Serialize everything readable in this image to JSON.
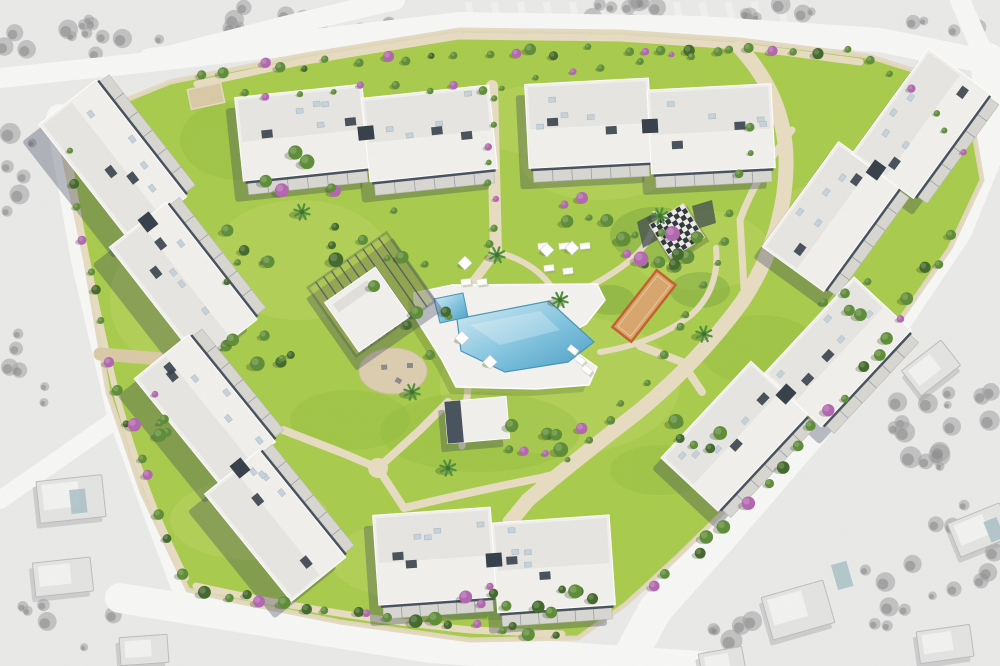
{
  "scene": {
    "description": "aerial masterplan rendering of a residential apartment development with central pool garden, surrounded by desaturated grayscale aerial context",
    "building_count": 7
  },
  "canvas": {
    "w": 1000,
    "h": 666
  },
  "palette": {
    "lawn": "#a9cc4b",
    "lawnLight": "#c2db69",
    "lawnDark": "#8db73a",
    "treeG": "#5d8c36",
    "treeD": "#42682a",
    "treeP": "#b266ae",
    "treeL": "#86b34a",
    "treeShadow": "rgba(30,45,20,0.25)",
    "path": "#e7dcc1",
    "pathDark": "#d9c9a6",
    "wall": "#e4d9c0",
    "roofWhite": "#f1f0ec",
    "roofLight": "#e0dfdb",
    "facadeDark": "#47515c",
    "facadeDeep": "#353f49",
    "terrace": "#d8d6d1",
    "acUnit": "#c6d2da",
    "shadow": "rgba(50,60,80,0.32)",
    "deck": "#f3f2ef",
    "poolEdge": "#4795b8",
    "sand": "#d8a56d",
    "sandBorder": "#c2602c",
    "dirt": "#dccdb0",
    "bgGray": "#e9e9e8",
    "road": "#f7f7f6",
    "grayTree": "#a0a0a0",
    "grayTreeDark": "#818181",
    "houseGray": "#e3e3e2",
    "houseRoof": "#f2f2f1",
    "houseStroke": "#bcbcbc",
    "housePool": "#a9c0c6"
  },
  "context": {
    "roads": [
      {
        "d": "M150,60 L460,24 L700,28 L880,40 L988,62",
        "w": 24
      },
      {
        "d": "M395,0 L285,26 L160,58",
        "w": 20
      },
      {
        "d": "M0,78 L150,62",
        "w": 20
      },
      {
        "d": "M60,118 L85,260 L120,410 L160,520 L188,594",
        "w": 28
      },
      {
        "d": "M115,420 L0,500",
        "w": 18
      },
      {
        "d": "M120,598 L430,648 L700,666",
        "w": 30
      },
      {
        "d": "M988,60 L992,140 L955,230 L888,330 L812,430 L728,528 L655,610 L625,666",
        "w": 34
      },
      {
        "d": "M960,0 L985,58",
        "w": 20
      }
    ],
    "orchard_rows": {
      "x0": 468,
      "x1": 790,
      "step": 26,
      "y0": 2,
      "y1": 30,
      "w": 7
    },
    "gray_tree_clusters": [
      {
        "x": 60,
        "y": 30,
        "rx": 70,
        "ry": 28,
        "n": 12
      },
      {
        "x": 230,
        "y": 28,
        "rx": 90,
        "ry": 26,
        "n": 14
      },
      {
        "x": 390,
        "y": 42,
        "rx": 60,
        "ry": 22,
        "n": 8
      },
      {
        "x": 620,
        "y": 12,
        "rx": 80,
        "ry": 14,
        "n": 8
      },
      {
        "x": 790,
        "y": 14,
        "rx": 60,
        "ry": 12,
        "n": 6
      },
      {
        "x": 950,
        "y": 25,
        "rx": 40,
        "ry": 18,
        "n": 5
      },
      {
        "x": 935,
        "y": 400,
        "rx": 60,
        "ry": 70,
        "n": 16
      },
      {
        "x": 960,
        "y": 560,
        "rx": 50,
        "ry": 60,
        "n": 10
      },
      {
        "x": 860,
        "y": 600,
        "rx": 60,
        "ry": 40,
        "n": 8
      },
      {
        "x": 60,
        "y": 620,
        "rx": 60,
        "ry": 30,
        "n": 6
      },
      {
        "x": 40,
        "y": 360,
        "rx": 40,
        "ry": 45,
        "n": 6
      },
      {
        "x": 20,
        "y": 180,
        "rx": 30,
        "ry": 50,
        "n": 6
      },
      {
        "x": 760,
        "y": 632,
        "rx": 50,
        "ry": 20,
        "n": 5
      },
      {
        "x": 900,
        "y": 250,
        "rx": 30,
        "ry": 30,
        "n": 6
      }
    ],
    "houses": [
      {
        "x": 38,
        "y": 478,
        "w": 66,
        "h": 42,
        "rot": -6,
        "pool": [
          70,
          490,
          16,
          24
        ]
      },
      {
        "x": 34,
        "y": 560,
        "w": 58,
        "h": 34,
        "rot": -6
      },
      {
        "x": 120,
        "y": 636,
        "w": 48,
        "h": 28,
        "rot": -4
      },
      {
        "x": 766,
        "y": 588,
        "w": 64,
        "h": 44,
        "rot": -16,
        "pool": [
          842,
          576,
          16,
          26
        ]
      },
      {
        "x": 906,
        "y": 352,
        "w": 50,
        "h": 32,
        "rot": -38
      },
      {
        "x": 952,
        "y": 512,
        "w": 56,
        "h": 36,
        "rot": -22,
        "pool": [
          986,
          524,
          14,
          22
        ]
      },
      {
        "x": 918,
        "y": 628,
        "w": 54,
        "h": 32,
        "rot": -8
      },
      {
        "x": 700,
        "y": 650,
        "w": 44,
        "h": 24,
        "rot": -10
      }
    ]
  },
  "site": {
    "boundary": [
      [
        170,
        82
      ],
      [
        300,
        56
      ],
      [
        460,
        30
      ],
      [
        620,
        32
      ],
      [
        740,
        40
      ],
      [
        868,
        56
      ],
      [
        938,
        78
      ],
      [
        972,
        122
      ],
      [
        982,
        180
      ],
      [
        950,
        248
      ],
      [
        893,
        330
      ],
      [
        822,
        408
      ],
      [
        748,
        488
      ],
      [
        676,
        558
      ],
      [
        626,
        604
      ],
      [
        578,
        638
      ],
      [
        470,
        640
      ],
      [
        340,
        622
      ],
      [
        240,
        602
      ],
      [
        188,
        590
      ],
      [
        142,
        492
      ],
      [
        108,
        392
      ],
      [
        86,
        262
      ],
      [
        58,
        128
      ]
    ],
    "lawn_light_patches": [
      [
        300,
        260,
        90,
        60
      ],
      [
        560,
        385,
        120,
        70
      ],
      [
        250,
        520,
        80,
        40
      ],
      [
        700,
        250,
        70,
        40
      ],
      [
        820,
        220,
        50,
        35
      ],
      [
        420,
        560,
        90,
        40
      ],
      [
        600,
        160,
        80,
        40
      ],
      [
        160,
        300,
        50,
        60
      ],
      [
        540,
        120,
        70,
        35
      ]
    ],
    "lawn_dark_patches": [
      [
        480,
        432,
        100,
        40
      ],
      [
        350,
        420,
        60,
        30
      ],
      [
        760,
        350,
        60,
        35
      ],
      [
        240,
        140,
        60,
        40
      ],
      [
        660,
        470,
        50,
        25
      ]
    ],
    "groundcover": [
      [
        655,
        235,
        45,
        28
      ],
      [
        610,
        300,
        25,
        15
      ],
      [
        700,
        290,
        30,
        18
      ],
      [
        500,
        606,
        100,
        14
      ]
    ],
    "paths": [
      {
        "d": "M197,84 L300,62 L458,36 L620,38 L738,46 L860,62",
        "w": 7,
        "c": "path"
      },
      {
        "d": "M492,86 L496,252",
        "w": 12,
        "c": "path"
      },
      {
        "d": "M496,252 L470,286",
        "w": 9,
        "c": "path"
      },
      {
        "d": "M740,48 Q788,100 786,168 Q784,238 742,302 Q698,362 638,412 Q578,458 528,500 L510,522",
        "w": 15,
        "c": "path"
      },
      {
        "d": "M283,430 L340,452 L378,468 L420,430 L448,402",
        "w": 8,
        "c": "path"
      },
      {
        "d": "M378,468 L404,508",
        "w": 8,
        "c": "path"
      },
      {
        "d": "M404,508 Q470,492 540,478 L566,472",
        "w": 8,
        "c": "path"
      },
      {
        "d": "M66,140 Q84,260 118,400 Q146,500 186,578",
        "w": 6,
        "c": "path"
      },
      {
        "d": "M100,354 L198,362",
        "w": 13,
        "c": "pathDark"
      },
      {
        "d": "M196,586 Q330,616 470,630 L562,634",
        "w": 7,
        "c": "path"
      },
      {
        "d": "M560,300 Q600,284 628,262 Q656,240 654,214",
        "w": 6,
        "c": "path"
      },
      {
        "d": "M600,352 Q652,344 690,316 Q720,290 716,248",
        "w": 6,
        "c": "path"
      },
      {
        "d": "M496,252 Q540,262 560,300",
        "w": 6,
        "c": "path"
      },
      {
        "d": "M792,130 Q756,176 740,220 L744,288",
        "w": 7,
        "c": "path"
      },
      {
        "d": "M640,346 L682,362 L702,392",
        "w": 8,
        "c": "path"
      },
      {
        "d": "M468,388 L462,446",
        "w": 7,
        "c": "path"
      }
    ],
    "tree_belts": [
      {
        "p1": [
          205,
          72
        ],
        "c": [
          530,
          44
        ],
        "p2": [
          852,
          50
        ],
        "n": 26,
        "rmin": 3,
        "rmax": 6,
        "mix": "ggpgd"
      },
      {
        "p1": [
          872,
          62
        ],
        "c": [
          930,
          96
        ],
        "p2": [
          962,
          150
        ],
        "n": 6,
        "rmin": 3,
        "rmax": 5,
        "mix": "ggp"
      },
      {
        "p1": [
          948,
          236
        ],
        "c": [
          845,
          428
        ],
        "p2": [
          652,
          588
        ],
        "n": 20,
        "rmin": 3.5,
        "rmax": 7,
        "mix": "ggdgp"
      },
      {
        "p1": [
          204,
          590
        ],
        "c": [
          380,
          622
        ],
        "p2": [
          556,
          632
        ],
        "n": 18,
        "rmin": 3.5,
        "rmax": 7,
        "mix": "dgdpg"
      },
      {
        "p1": [
          72,
          150
        ],
        "c": [
          96,
          360
        ],
        "p2": [
          182,
          572
        ],
        "n": 15,
        "rmin": 3,
        "rmax": 6,
        "mix": "gdgp"
      },
      {
        "p1": [
          752,
          124
        ],
        "c": [
          724,
          330
        ],
        "p2": [
          564,
          462
        ],
        "n": 15,
        "rmin": 2.5,
        "rmax": 4.5,
        "mix": "ggg"
      },
      {
        "p1": [
          490,
          100
        ],
        "c": [
          492,
          170
        ],
        "p2": [
          494,
          244
        ],
        "n": 8,
        "rmin": 2.5,
        "rmax": 4,
        "mix": "ggp"
      },
      {
        "p1": [
          240,
          96
        ],
        "c": [
          360,
          86
        ],
        "p2": [
          484,
          88
        ],
        "n": 9,
        "rmin": 2.5,
        "rmax": 4.5,
        "mix": "gpg"
      },
      {
        "p1": [
          504,
          88
        ],
        "c": [
          620,
          60
        ],
        "p2": [
          730,
          52
        ],
        "n": 8,
        "rmin": 2.5,
        "rmax": 4,
        "mix": "ggp"
      }
    ],
    "tree_clusters": [
      {
        "x": 662,
        "y": 238,
        "rx": 52,
        "ry": 36,
        "n": 13,
        "mix": "gdpg"
      },
      {
        "x": 380,
        "y": 248,
        "rx": 55,
        "ry": 40,
        "n": 9,
        "mix": "gdg"
      },
      {
        "x": 300,
        "y": 180,
        "rx": 40,
        "ry": 30,
        "n": 7,
        "mix": "gpg"
      },
      {
        "x": 540,
        "y": 440,
        "rx": 70,
        "ry": 26,
        "n": 8,
        "mix": "gpg"
      },
      {
        "x": 262,
        "y": 352,
        "rx": 45,
        "ry": 26,
        "n": 7,
        "mix": "gdg"
      },
      {
        "x": 152,
        "y": 428,
        "rx": 34,
        "ry": 36,
        "n": 6,
        "mix": "gpg"
      },
      {
        "x": 704,
        "y": 432,
        "rx": 36,
        "ry": 26,
        "n": 6,
        "mix": "gdg"
      },
      {
        "x": 848,
        "y": 296,
        "rx": 30,
        "ry": 22,
        "n": 5,
        "mix": "gg"
      },
      {
        "x": 536,
        "y": 598,
        "rx": 85,
        "ry": 16,
        "n": 11,
        "mix": "dgpd"
      },
      {
        "x": 430,
        "y": 332,
        "rx": 26,
        "ry": 36,
        "n": 5,
        "mix": "gdg"
      },
      {
        "x": 586,
        "y": 214,
        "rx": 30,
        "ry": 20,
        "n": 5,
        "mix": "gpg"
      },
      {
        "x": 240,
        "y": 250,
        "rx": 30,
        "ry": 40,
        "n": 6,
        "mix": "gdg"
      }
    ],
    "palms": [
      [
        497,
        255
      ],
      [
        302,
        212
      ],
      [
        412,
        392
      ],
      [
        660,
        216
      ],
      [
        704,
        334
      ],
      [
        448,
        468
      ],
      [
        560,
        300
      ]
    ],
    "buildings": [
      {
        "id": "apartment-block-west",
        "cx": 148,
        "cy": 222,
        "rot": 52,
        "flip": true,
        "blocks": [
          [
            -70,
            -10,
            148,
            72
          ],
          [
            70,
            10,
            148,
            72
          ]
        ]
      },
      {
        "id": "apartment-block-northwest",
        "cx": 366,
        "cy": 133,
        "rot": -6,
        "flip": false,
        "blocks": [
          [
            -63,
            -7,
            128,
            84
          ],
          [
            63,
            7,
            128,
            84
          ]
        ]
      },
      {
        "id": "apartment-block-north",
        "cx": 650,
        "cy": 126,
        "rot": -3,
        "flip": false,
        "blocks": [
          [
            -61,
            -6,
            124,
            84
          ],
          [
            61,
            6,
            124,
            84
          ]
        ]
      },
      {
        "id": "apartment-block-east",
        "cx": 876,
        "cy": 170,
        "rot": -54,
        "flip": false,
        "blocks": [
          [
            -64,
            -9,
            130,
            76
          ],
          [
            64,
            9,
            130,
            76
          ]
        ]
      },
      {
        "id": "apartment-block-southeast",
        "cx": 786,
        "cy": 394,
        "rot": -47,
        "flip": false,
        "blocks": [
          [
            -66,
            -9,
            132,
            78
          ],
          [
            66,
            9,
            132,
            78
          ]
        ]
      },
      {
        "id": "apartment-block-south",
        "cx": 494,
        "cy": 560,
        "rot": -4,
        "flip": false,
        "blocks": [
          [
            -59,
            -8,
            118,
            90
          ],
          [
            59,
            8,
            118,
            90
          ]
        ]
      },
      {
        "id": "apartment-block-southwest",
        "cx": 240,
        "cy": 468,
        "rot": 51,
        "flip": true,
        "blocks": [
          [
            -67,
            -9,
            138,
            70
          ],
          [
            67,
            9,
            138,
            70
          ]
        ]
      }
    ],
    "clubhouse": {
      "cx": 378,
      "cy": 297,
      "rot": -35,
      "pergola": [
        -4,
        -6,
        96,
        84
      ],
      "roof": [
        -16,
        4,
        62,
        60
      ]
    },
    "pavilion": {
      "cx": 477,
      "cy": 420,
      "rot": -5,
      "w": 62,
      "h": 42
    },
    "pool": {
      "deck": [
        [
          414,
          293
        ],
        [
          452,
          285
        ],
        [
          597,
          284
        ],
        [
          605,
          300
        ],
        [
          586,
          324
        ],
        [
          559,
          340
        ],
        [
          597,
          367
        ],
        [
          589,
          385
        ],
        [
          536,
          389
        ],
        [
          456,
          387
        ],
        [
          442,
          360
        ],
        [
          415,
          317
        ]
      ],
      "water_main": [
        [
          457,
          319
        ],
        [
          549,
          301
        ],
        [
          594,
          342
        ],
        [
          568,
          362
        ],
        [
          505,
          372
        ],
        [
          461,
          351
        ]
      ],
      "water_small": [
        [
          434,
          299
        ],
        [
          463,
          293
        ],
        [
          468,
          317
        ],
        [
          440,
          323
        ]
      ]
    },
    "amenities": {
      "chessboard": {
        "cx": 677,
        "cy": 231,
        "rot": -32,
        "size": 40
      },
      "petanque_court": {
        "cx": 644,
        "cy": 306,
        "rot": -52,
        "w": 72,
        "h": 24
      },
      "playground": {
        "cx": 393,
        "cy": 371,
        "rx": 34,
        "ry": 23
      },
      "shade_sails": [
        [
          [
            637,
            222
          ],
          [
            656,
            212
          ],
          [
            661,
            238
          ],
          [
            643,
            248
          ]
        ],
        [
          [
            692,
            206
          ],
          [
            712,
            200
          ],
          [
            716,
            223
          ],
          [
            697,
            229
          ]
        ]
      ]
    },
    "furniture": {
      "lounger_rows": [
        {
          "x": 543,
          "y": 246,
          "rot": -7,
          "n": 3,
          "dx": 21,
          "dy": 0
        },
        {
          "x": 549,
          "y": 268,
          "rot": -7,
          "n": 2,
          "dx": 19,
          "dy": 3
        },
        {
          "x": 573,
          "y": 350,
          "rot": 38,
          "n": 3,
          "dx": 7,
          "dy": 10
        },
        {
          "x": 466,
          "y": 282,
          "rot": -7,
          "n": 2,
          "dx": 16,
          "dy": 0
        }
      ],
      "parasols": [
        [
          465,
          263
        ],
        [
          547,
          250
        ],
        [
          572,
          248
        ],
        [
          462,
          338
        ],
        [
          490,
          362
        ]
      ]
    },
    "entrance_ramp": {
      "x": 206,
      "y": 96,
      "w": 34,
      "h": 20,
      "rot": -12
    }
  }
}
